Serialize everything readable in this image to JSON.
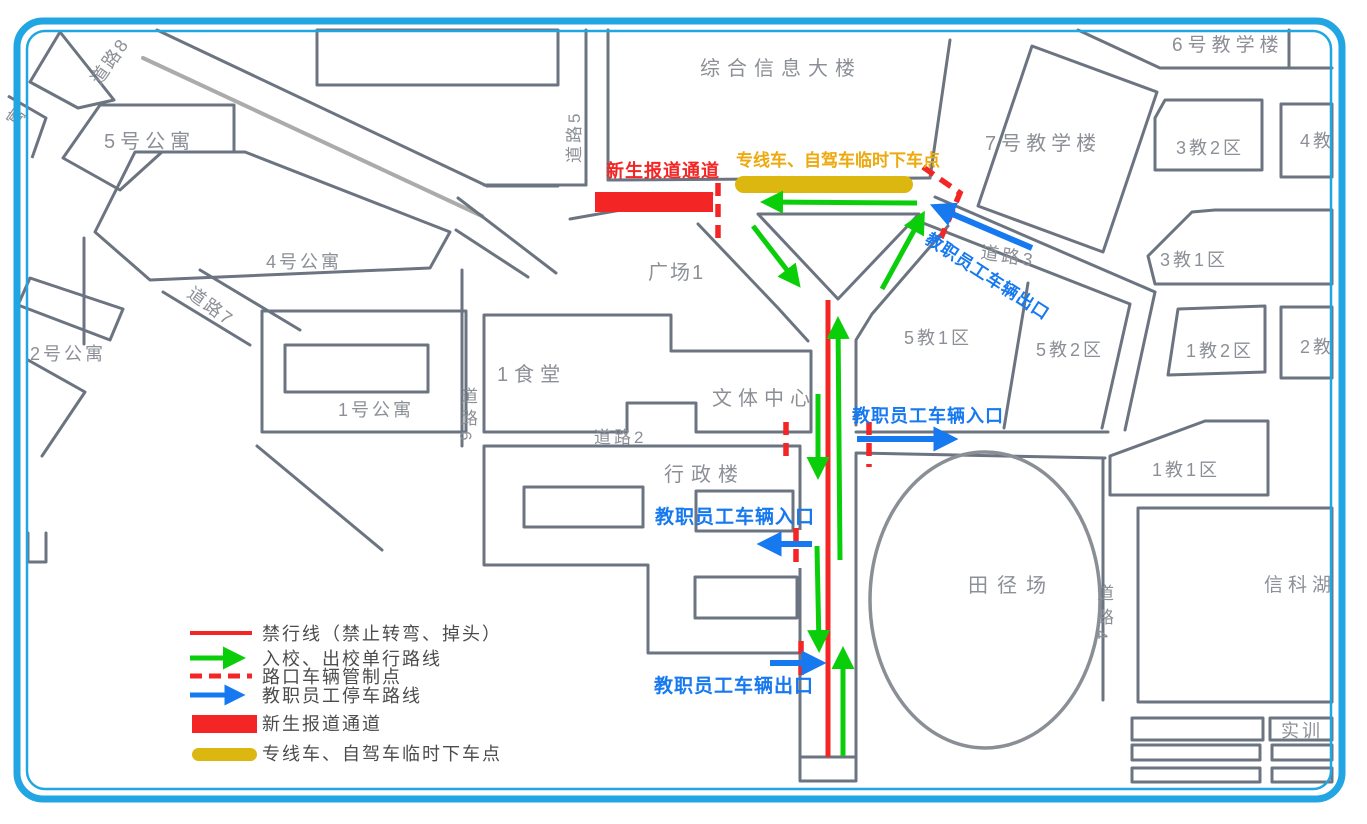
{
  "colors": {
    "border_blue": "#22a6e3",
    "building_outline": "#6b7480",
    "building_label": "#8c9096",
    "forbid_red": "#f42525",
    "route_green": "#0bce0b",
    "staff_blue": "#1679f0",
    "dropoff_gold": "#dbb70f",
    "dropoff_gold_text": "#eda90d",
    "legend_text": "#4c4c4c"
  },
  "buildings": {
    "apt5": "5号公寓",
    "apt4": "4号公寓",
    "apt2": "2号公寓",
    "apt1": "1号公寓",
    "apt_partial": "寓",
    "info_building": "综合信息大楼",
    "teach6": "6号教学楼",
    "teach7": "7号教学楼",
    "j3z2": "3教2区",
    "j4": "4教",
    "j3z1": "3教1区",
    "j1z2": "1教2区",
    "j2": "2教",
    "j1z1": "1教1区",
    "j5z1": "5教1区",
    "j5z2": "5教2区",
    "canteen": "1食堂",
    "sports_center": "文体中心",
    "admin": "行政楼",
    "plaza": "广场1",
    "track": "田径场",
    "lake": "信科湖",
    "training": "实训"
  },
  "roads": {
    "r8": "道路8",
    "r5": "道路5",
    "r7": "道路7",
    "r6c1": "道",
    "r6c2": "路",
    "r6n": "6",
    "r2": "道路2",
    "r3": "道路3",
    "r4c1": "道",
    "r4c2": "路",
    "r4n": "4"
  },
  "annotations": {
    "freshman_channel": "新生报道通道",
    "dropoff_point": "专线车、自驾车临时下车点",
    "staff_exit_ne": "教职员工车辆出口",
    "staff_entry_east": "教职员工车辆入口",
    "staff_entry_west": "教职员工车辆入口",
    "staff_exit_south": "教职员工车辆出口"
  },
  "legend": {
    "items": [
      {
        "symbol": "red-line",
        "label": "禁行线（禁止转弯、掉头）"
      },
      {
        "symbol": "green-arrow",
        "label": "入校、出校单行路线"
      },
      {
        "symbol": "red-dashed-line",
        "label": "路口车辆管制点"
      },
      {
        "symbol": "blue-arrow",
        "label": "教职员工停车路线"
      },
      {
        "symbol": "red-block",
        "label": "新生报道通道"
      },
      {
        "symbol": "gold-bar",
        "label": "专线车、自驾车临时下车点"
      }
    ]
  }
}
